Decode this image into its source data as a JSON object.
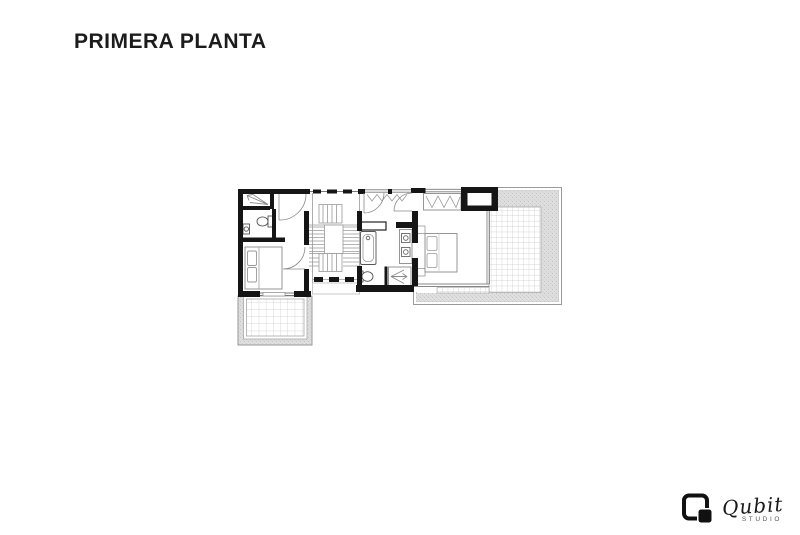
{
  "page": {
    "background_color": "#ffffff"
  },
  "header": {
    "title": "PRIMERA PLANTA",
    "title_color": "#1c1c1c"
  },
  "floor_plan": {
    "colors": {
      "wall": "#151515",
      "furniture_line": "#8a8a8a",
      "thin_line": "#999999",
      "terrace_stipple": "#dedede",
      "tile_line": "#c9c9c9",
      "terrace_outline": "#9a9a9a"
    }
  },
  "logo": {
    "brand": "Qubit",
    "subtitle": "STUDIO"
  }
}
